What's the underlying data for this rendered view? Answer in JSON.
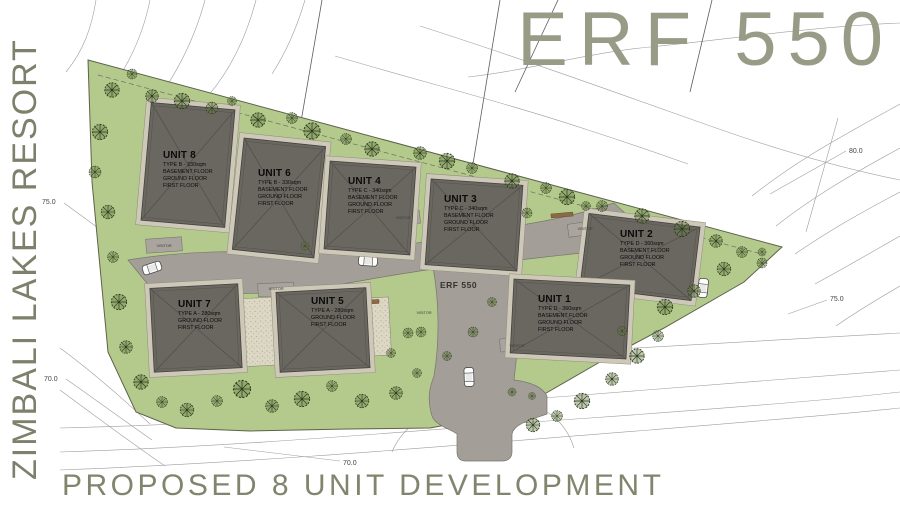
{
  "titles": {
    "side": "ZIMBALI LAKES RESORT",
    "main": "ERF 550",
    "bottom": "PROPOSED 8 UNIT DEVELOPMENT"
  },
  "road_label": "ERF 550",
  "visitor_label": "VISITOR",
  "contour_labels": [
    "80.0",
    "75.0",
    "75.0",
    "70.0",
    "70.0"
  ],
  "units": [
    {
      "name": "UNIT 1",
      "type": "TYPE D - 360sqm",
      "floors": [
        "BASEMENT FLOOR",
        "GROUND FLOOR",
        "FIRST FLOOR"
      ]
    },
    {
      "name": "UNIT 2",
      "type": "TYPE D - 360sqm",
      "floors": [
        "BASEMENT FLOOR",
        "GROUND FLOOR",
        "FIRST FLOOR"
      ]
    },
    {
      "name": "UNIT 3",
      "type": "TYPE C - 340sqm",
      "floors": [
        "BASEMENT FLOOR",
        "GROUND FLOOR",
        "FIRST FLOOR"
      ]
    },
    {
      "name": "UNIT 4",
      "type": "TYPE C - 340sqm",
      "floors": [
        "BASEMENT FLOOR",
        "GROUND FLOOR",
        "FIRST FLOOR"
      ]
    },
    {
      "name": "UNIT 5",
      "type": "TYPE A - 280sqm",
      "floors": [
        "GROUND FLOOR",
        "FIRST FLOOR"
      ]
    },
    {
      "name": "UNIT 6",
      "type": "TYPE B - 330sqm",
      "floors": [
        "BASEMENT FLOOR",
        "GROUND FLOOR",
        "FIRST FLOOR"
      ]
    },
    {
      "name": "UNIT 7",
      "type": "TYPE A - 280sqm",
      "floors": [
        "GROUND FLOOR",
        "FIRST FLOOR"
      ]
    },
    {
      "name": "UNIT 8",
      "type": "TYPE B - 330sqm",
      "floors": [
        "BASEMENT FLOOR",
        "GROUND FLOOR",
        "FIRST FLOOR"
      ]
    }
  ],
  "colors": {
    "title": "#81856d",
    "site_green": "#b3ca8c",
    "road": "#a39e98",
    "roof": "#6a6761",
    "courtyard": "#ddd8c5",
    "tree": "#2c3a1c"
  }
}
